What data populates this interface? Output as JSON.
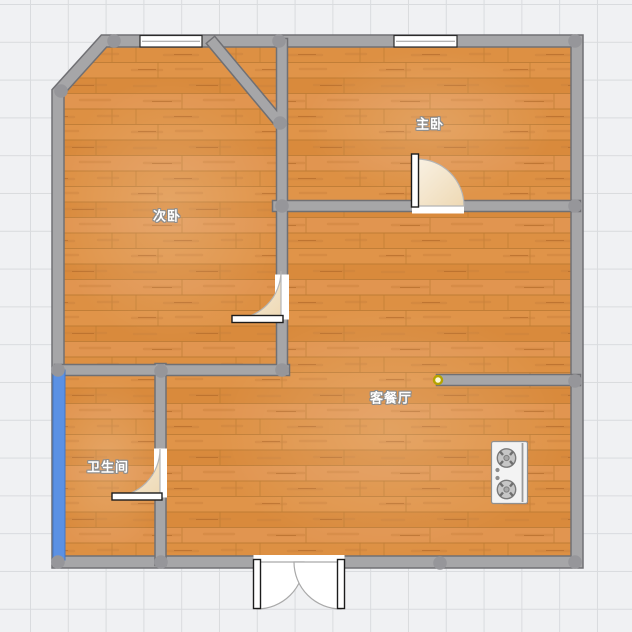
{
  "page": {
    "type": "floor-plan-canvas"
  },
  "rooms": {
    "secondary_bedroom": {
      "label": "次卧"
    },
    "master_bedroom": {
      "label": "主卧"
    },
    "living_dining": {
      "label": "客餐厅"
    },
    "bathroom": {
      "label": "卫生间"
    }
  },
  "colors": {
    "canvas_background": "#f0f1f3",
    "grid_line": "#d9dbde",
    "wall_fill": "#a6a6a8",
    "wall_edge": "#707074",
    "joint_node": "#96969a",
    "floor_wood_base": "#dc8e40",
    "door_swing_fill": "#f3e4cb",
    "window_glass": "#ffffff",
    "balcony_window_blue": "#5b91e4",
    "endpoint_marker_yellow": "#b5a300",
    "stove_body": "#f3f3f3"
  },
  "icons": {
    "stove": "gas-cooktop-icon",
    "marker": "wall-endpoint-icon"
  }
}
